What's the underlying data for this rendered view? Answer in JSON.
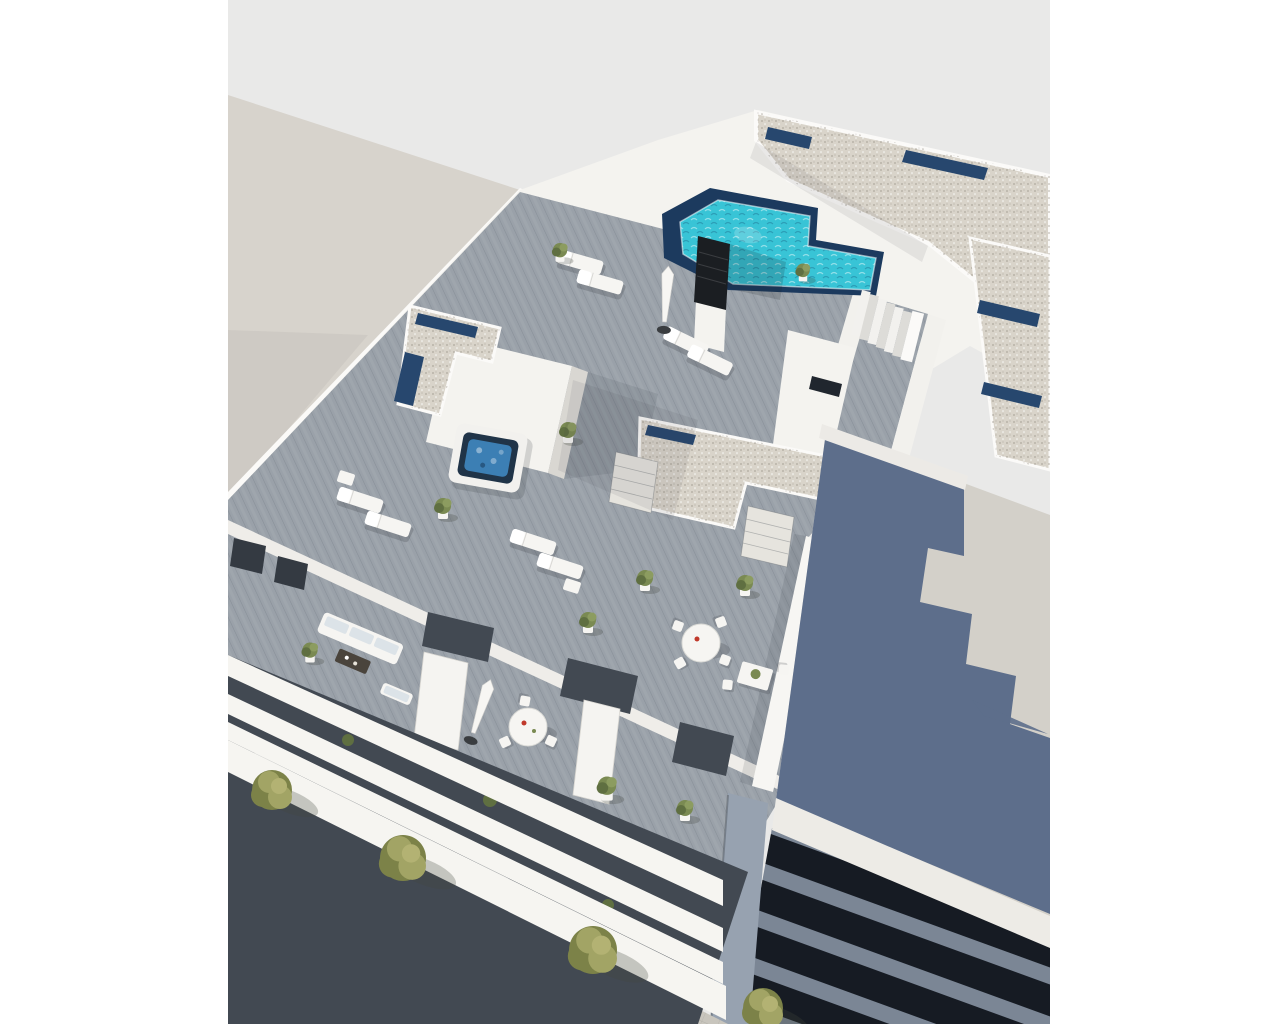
{
  "meta": {
    "description": "Aerial 3D architectural render of a modern white apartment building with an L-shaped rooftop pool, sun terraces with loungers, a jacuzzi, planted balconies, a street with trees below, and neighbouring buildings."
  },
  "colors": {
    "white_margin": "#ffffff",
    "photo_bg": "#e9e9e8",
    "neighbor_roof_beige": "#d7d3cc",
    "wall_white": "#f4f3ef",
    "wall_lit": "#fbfaf8",
    "wall_shade": "#d9d7d2",
    "deck": "#9aa1a9",
    "gravel": "#d9d4ca",
    "skylight_navy": "#27476e",
    "pool_turquoise": "#38c4d6",
    "pool_navy_edge": "#1c3a5e",
    "jacuzzi_blue": "#3c7fb4",
    "jacuzzi_dark": "#203448",
    "plant_green": "#7a8a52",
    "plant_dark": "#5f6f41",
    "tree_olive": "#a2a465",
    "tree_dark": "#7c8248",
    "asphalt": "#9d9c99",
    "sidewalk": "#c8c5bd",
    "road_mark": "#eeeeea",
    "shadow_blue": "#5d6e8b",
    "neighbor_roof_gray": "#d3d0c9",
    "fascia_light": "#edebe6",
    "dark_band": "#161b23",
    "slate_band": "#7b8695",
    "pillar_gray": "#97a2b0",
    "recess_dark": "#424952",
    "furniture_white": "#f6f5f2",
    "accent_red": "#c0392b",
    "umbrella_base": "#3a3d40",
    "chimney_dark": "#1b1e22",
    "cushion_blue": "#dce3e8"
  },
  "scene": {
    "objects": [
      "main-apartment-building",
      "rooftop-pool",
      "pool-stairs",
      "chimney",
      "gravel-roofs",
      "skylights",
      "jacuzzi",
      "sun-loungers",
      "closed-umbrellas",
      "round-dining-tables",
      "rect-dining-table",
      "outdoor-sofa-set",
      "potted-plants",
      "balcony-facade-bands",
      "street",
      "sidewalk",
      "street-trees",
      "lane-markings",
      "neighbor-building-top-left",
      "neighbor-building-right",
      "roof-shadow"
    ],
    "counts": {
      "sun_loungers": 8,
      "street_trees": 4,
      "dining_tables": 3,
      "facade_bands": 4,
      "lane_dashes": 5
    }
  }
}
